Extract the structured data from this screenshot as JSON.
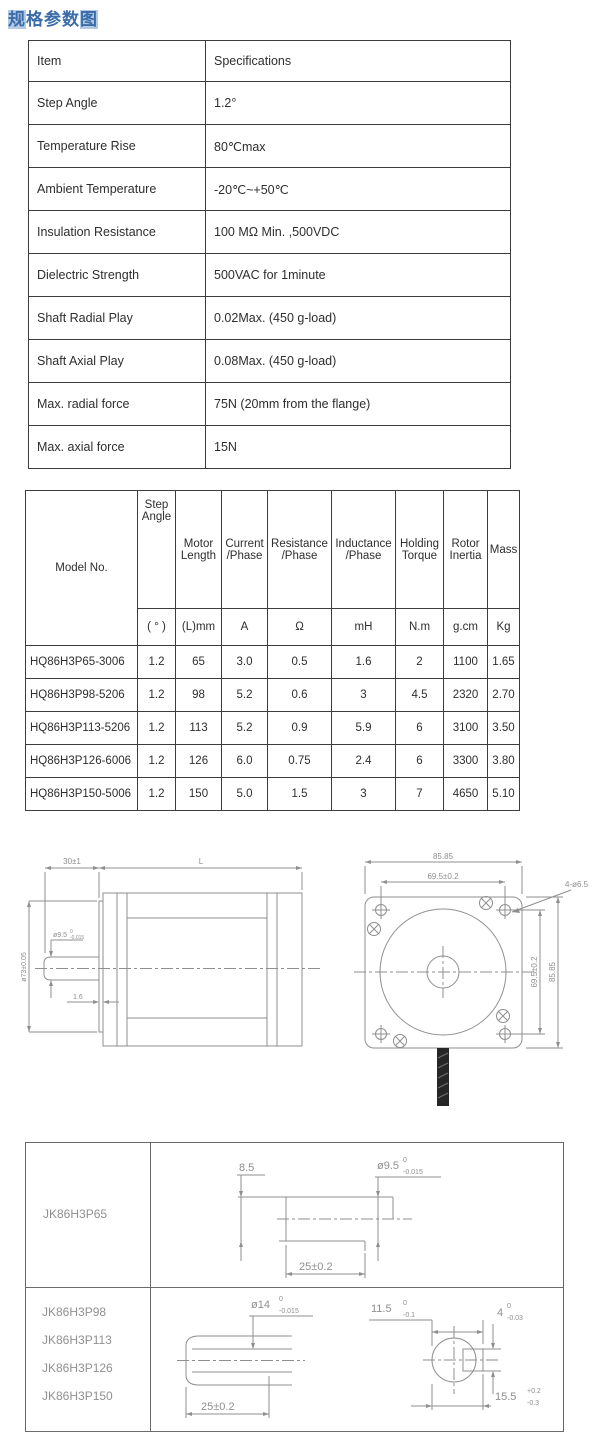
{
  "page": {
    "title_hl_start": "规",
    "title_mid": "格参数",
    "title_hl_end": "图"
  },
  "colors": {
    "title_text": "#3b6caa",
    "title_highlight": "#b3c9e4",
    "table_border": "#3c3c3c",
    "drawing_line": "#8f8f8f"
  },
  "spec_table": {
    "header": {
      "item": "Item",
      "spec": "Specifications"
    },
    "rows": [
      {
        "item": "Step Angle",
        "spec": "1.2°"
      },
      {
        "item": "Temperature Rise",
        "spec": "80℃max"
      },
      {
        "item": "Ambient Temperature",
        "spec": "-20℃~+50℃"
      },
      {
        "item": "Insulation Resistance",
        "spec": "100 MΩ Min. ,500VDC"
      },
      {
        "item": "Dielectric Strength",
        "spec": "500VAC for 1minute"
      },
      {
        "item": "Shaft Radial Play",
        "spec": "0.02Max. (450 g-load)"
      },
      {
        "item": "Shaft Axial Play",
        "spec": "0.08Max. (450 g-load)"
      },
      {
        "item": "Max. radial force",
        "spec": "75N (20mm from the flange)"
      },
      {
        "item": "Max. axial force",
        "spec": "15N"
      }
    ]
  },
  "model_table": {
    "header": {
      "model": "Model No.",
      "step": "Step Angle",
      "length": "Motor Length",
      "current": "Current /Phase",
      "resistance": "Resistance /Phase",
      "inductance": "Inductance /Phase",
      "torque": "Holding Torque",
      "inertia": "Rotor Inertia",
      "mass": "Mass"
    },
    "units": {
      "step": "( ° )",
      "length": "(L)mm",
      "current": "A",
      "resistance": "Ω",
      "inductance": "mH",
      "torque": "N.m",
      "inertia": "g.cm",
      "mass": "Kg"
    },
    "rows": [
      {
        "model": "HQ86H3P65-3006",
        "step": "1.2",
        "length": "65",
        "current": "3.0",
        "resistance": "0.5",
        "inductance": "1.6",
        "torque": "2",
        "inertia": "1100",
        "mass": "1.65"
      },
      {
        "model": "HQ86H3P98-5206",
        "step": "1.2",
        "length": "98",
        "current": "5.2",
        "resistance": "0.6",
        "inductance": "3",
        "torque": "4.5",
        "inertia": "2320",
        "mass": "2.70"
      },
      {
        "model": "HQ86H3P113-5206",
        "step": "1.2",
        "length": "113",
        "current": "5.2",
        "resistance": "0.9",
        "inductance": "5.9",
        "torque": "6",
        "inertia": "3100",
        "mass": "3.50"
      },
      {
        "model": "HQ86H3P126-6006",
        "step": "1.2",
        "length": "126",
        "current": "6.0",
        "resistance": "0.75",
        "inductance": "2.4",
        "torque": "6",
        "inertia": "3300",
        "mass": "3.80"
      },
      {
        "model": "HQ86H3P150-5006",
        "step": "1.2",
        "length": "150",
        "current": "5.0",
        "resistance": "1.5",
        "inductance": "3",
        "torque": "7",
        "inertia": "4650",
        "mass": "5.10"
      }
    ]
  },
  "side_view": {
    "dim_shaft_ext": "30±1",
    "dim_length": "L",
    "dim_flange_dia": "ø73±0.05",
    "shaft_dia": "ø9.5",
    "shaft_tol_sup": "0",
    "shaft_tol_sub": "-0.015",
    "dim_boss": "1.6"
  },
  "front_view": {
    "dim_width_outer": "85.85",
    "dim_width_holes": "69.5±0.2",
    "holes_label": "4-ø6.5",
    "dim_height_holes": "69.5±0.2",
    "dim_height_outer": "85.85"
  },
  "shaft_table": {
    "row1": {
      "model": "JK86H3P65",
      "dim_flat": "8.5",
      "dia": "ø9.5",
      "dia_tol_sup": "0",
      "dia_tol_sub": "-0.015",
      "dim_len": "25±0.2"
    },
    "row2": {
      "models": [
        "JK86H3P98",
        "JK86H3P113",
        "JK86H3P126",
        "JK86H3P150"
      ],
      "dia": "ø14",
      "dia_tol_sup": "0",
      "dia_tol_sub": "-0.015",
      "dim_len": "25±0.2",
      "dim_flat": "11.5",
      "flat_tol_sup": "0",
      "flat_tol_sub": "-0.1",
      "key_w": "4",
      "key_tol_sup": "0",
      "key_tol_sub": "-0.03",
      "dim_total": "15.5",
      "total_tol_sup": "+0.2",
      "total_tol_sub": "-0.3"
    }
  }
}
